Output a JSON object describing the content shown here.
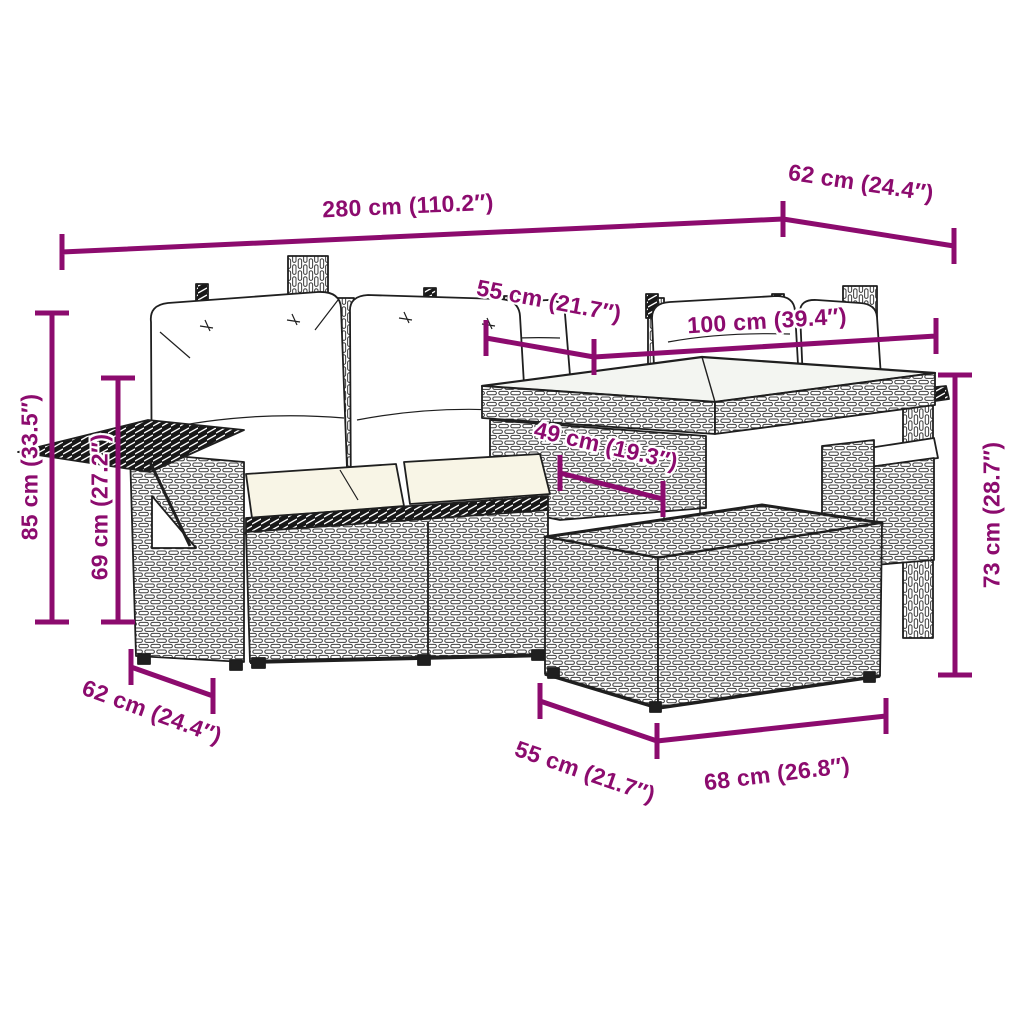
{
  "diagram": {
    "subject": "5-piece rattan garden lounge set with cushions, glass-top table and ottoman",
    "accent_color": "#8C0B6E",
    "outline_color": "#1F1F1F",
    "background_color": "#FFFFFF"
  },
  "dimension_labels": {
    "top_width": "280 cm (110.2″)",
    "top_right_depth": "62 cm (24.4″)",
    "mid_seat_width": "55 cm (21.7″)",
    "mid_table_width": "100 cm (39.4″)",
    "table_depth": "49 cm (19.3″)",
    "left_back_height": "85 cm (33.5″)",
    "left_arm_height": "69 cm (27.2″)",
    "right_table_height": "73 cm (28.7″)",
    "bottom_left_depth": "62 cm (24.4″)",
    "bottom_ottoman_depth": "55 cm (21.7″)",
    "bottom_ottoman_width": "68 cm (26.8″)"
  }
}
